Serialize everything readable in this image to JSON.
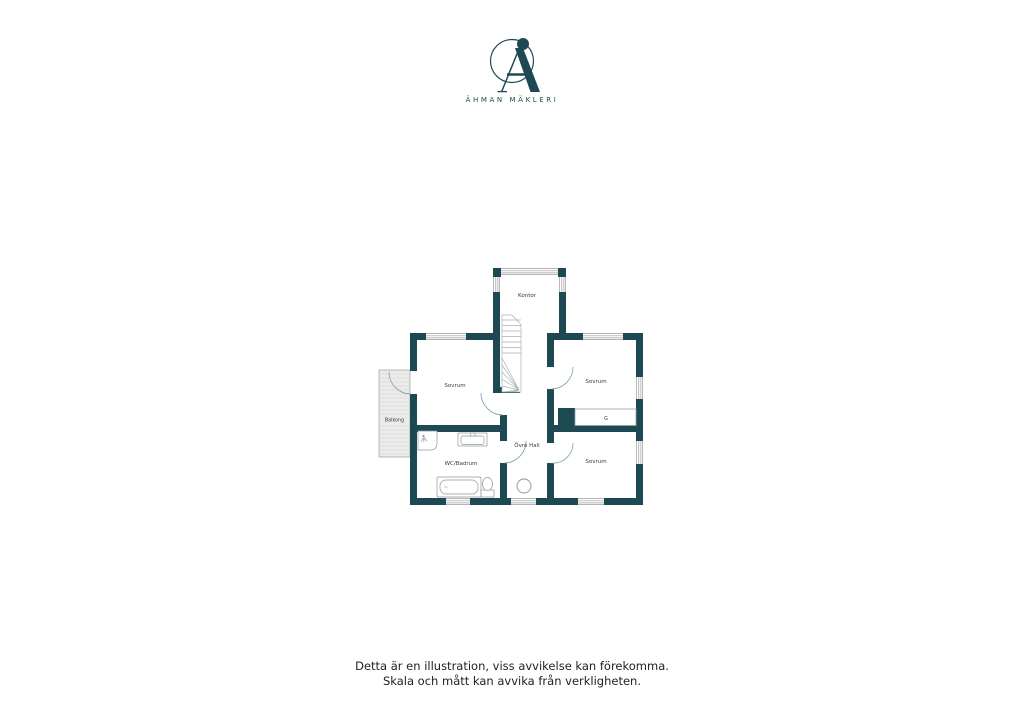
{
  "brand": {
    "name": "ÄHMAN MÄKLERI",
    "color": "#1d4a52"
  },
  "colors": {
    "wall": "#1d4a52",
    "fixture_line": "#8f999c",
    "window_line": "#9c9c9c",
    "door_arc": "#7fa0aa",
    "balcony_fill": "#ebebeb",
    "balcony_stripe": "#d4d4d4",
    "label_text": "#3a3a3a"
  },
  "floorplan": {
    "rooms": [
      {
        "id": "kontor",
        "label": "Kontor"
      },
      {
        "id": "sovrum-left",
        "label": "Sovrum"
      },
      {
        "id": "sovrum-top-right",
        "label": "Sovrum"
      },
      {
        "id": "sovrum-bottom-right",
        "label": "Sovrum"
      },
      {
        "id": "wc-badrum",
        "label": "WC/Badrum"
      },
      {
        "id": "ovre-hall",
        "label": "Övre Hall"
      },
      {
        "id": "balkong",
        "label": "Balkong"
      },
      {
        "id": "garderob",
        "label": "G"
      }
    ]
  },
  "disclaimer": {
    "line1": "Detta är en illustration, viss avvikelse kan förekomma.",
    "line2": "Skala och mått kan avvika från verkligheten."
  }
}
